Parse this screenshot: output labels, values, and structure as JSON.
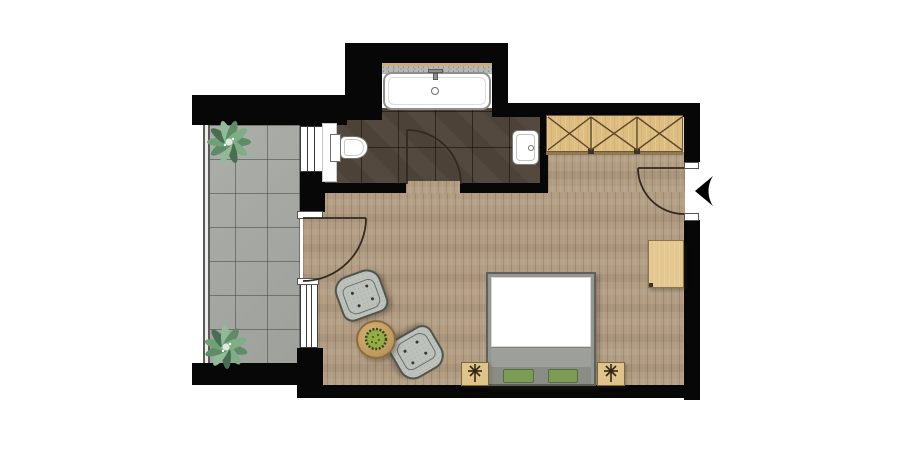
{
  "app": {
    "type": "architectural-floor-plan",
    "view": "top-down 2D render",
    "description": "studio apartment / hotel room floor plan with balcony, bathroom and main living room"
  },
  "colors": {
    "wall": "#070707",
    "bg": "#ffffff",
    "wood": "#b19c82",
    "tile": "#a7a9a4",
    "btile": "#4d4237",
    "wardrobe": "#ddbe80",
    "wood-line": "#6e5637",
    "chair": "#bcc1bc",
    "chair-line": "#51564d",
    "bed-frame": "#94978f",
    "bed-border": "#5f5f5d",
    "mattress": "#ffffff",
    "pillow": "#7b9a53",
    "pillow-border": "#55703a",
    "fixture": "#ffffff",
    "fixture-line": "#77777a",
    "counter": "#b7b7b5",
    "counter-edge": "#c9ad7c",
    "stand": "#e0c28b",
    "desk": "#e3c78f",
    "table": "#c9a56a",
    "door-line": "#33291e",
    "arrow": "#000000"
  },
  "rooms": [
    {
      "name": "balcony",
      "floor": "gray ceramic tiles",
      "features": [
        "glass railing",
        "potted plant top",
        "potted plant bottom"
      ]
    },
    {
      "name": "bathroom",
      "floor": "dark brown tiles",
      "fixtures": [
        "bathtub with counter and faucet",
        "toilet",
        "washbasin"
      ]
    },
    {
      "name": "main-room",
      "floor": "light oak planks",
      "furniture": [
        "double bed with green pillows",
        "nightstand left",
        "nightstand right",
        "armchair upper",
        "armchair lower",
        "round side table with plant",
        "three-door wardrobe",
        "wall desk"
      ]
    }
  ],
  "openings": [
    {
      "name": "entry-door",
      "location": "right wall",
      "marker": "black entry arrow pointing left"
    },
    {
      "name": "bathroom-door",
      "location": "bathroom south wall",
      "swing": "into bathroom"
    },
    {
      "name": "balcony-door",
      "location": "left wall",
      "swing": "into main room"
    },
    {
      "name": "bathroom-window",
      "location": "left wall behind toilet"
    },
    {
      "name": "room-window",
      "location": "left wall lower"
    }
  ]
}
